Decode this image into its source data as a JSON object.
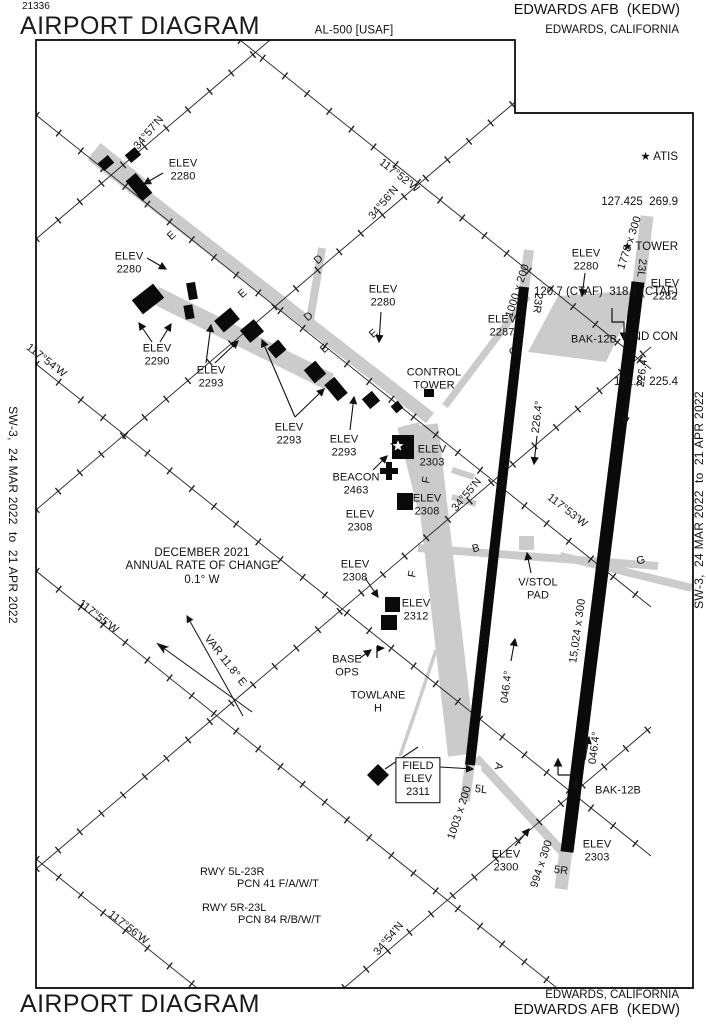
{
  "header": {
    "chart_number": "21336",
    "title": "AIRPORT DIAGRAM",
    "procedure_id": "AL-500 [USAF]",
    "airport": "EDWARDS AFB  (KEDW)",
    "city": "EDWARDS, CALIFORNIA"
  },
  "frequencies": {
    "atis_label": "★ ATIS",
    "atis_freqs": "127.425  269.9",
    "tower_label": "★ TOWER",
    "tower_freqs": "120.7 (CTAF)  318.1 (CTAF)",
    "gnd_label": "GND CON",
    "gnd_freqs": "121.8  225.4"
  },
  "edges": {
    "left": "SW-3,  24 MAR 2022  to  21 APR 2022",
    "right": "SW-3,  24 MAR 2022  to  21 APR 2022"
  },
  "footer": {
    "title": "AIRPORT DIAGRAM",
    "city": "EDWARDS, CALIFORNIA",
    "airport": "EDWARDS AFB  (KEDW)"
  },
  "colors": {
    "runway": "#0a0a0a",
    "taxiway": "#cbcbcb",
    "ink": "#111111"
  },
  "map": {
    "labels": {
      "lat57": "34°57'N",
      "lat56": "34°56'N",
      "lat55": "34°55'N",
      "lat54": "34°54'N",
      "lon52": "117°52'W",
      "lon53": "117°53'W",
      "lon54": "117°54'W",
      "lon55": "117°55'W",
      "lon56": "117°56'W",
      "elev2280a": "ELEV\n2280",
      "elev2280b": "ELEV\n2280",
      "elev2280c": "ELEV\n2280",
      "elev2280d": "ELEV\n2280",
      "elev2290": "ELEV\n2290",
      "elev2293a": "ELEV\n2293",
      "elev2293b": "ELEV\n2293",
      "elev2293c": "ELEV\n2293",
      "elev2287": "ELEV\n2287",
      "elev2282": "ELEV\n2282",
      "control_tower": "CONTROL\nTOWER",
      "elev2303a": "ELEV\n2303",
      "beacon": "BEACON\n2463",
      "elev2308a": "ELEV\n2308",
      "elev2308b": "ELEV\n2308",
      "elev2308c": "ELEV\n2308",
      "elev2312": "ELEV\n2312",
      "base_ops": "BASE\nOPS",
      "towlane": "TOWLANE\nH",
      "field_elev": "FIELD\nELEV\n2311",
      "elev2300": "ELEV\n2300",
      "elev2303b": "ELEV\n2303",
      "bak12b_top": "BAK-12B",
      "bak12b_bottom": "BAK-12B",
      "vstol": "V/STOL\nPAD",
      "mag_note": "DECEMBER 2021\nANNUAL RATE OF CHANGE\n0.1° W",
      "var_label": "VAR 11.8° E",
      "rwy1": "RWY 5L-23R",
      "pcn1": "PCN 41 F/A/W/T",
      "rwy2": "RWY 5R-23L",
      "pcn2": "PCN 84 R/B/W/T",
      "dim_1000": "1000 x 200",
      "dim_1778": "1778 x 300",
      "dim_12000": "12,000 x 200",
      "dim_15024": "15,024 x 300",
      "dim_1003": "1003 x 200",
      "dim_994": "994 x 300",
      "thr_23r": "23R",
      "thr_23l": "23L",
      "thr_5l": "5L",
      "thr_5r": "5R",
      "hdg_226a": "226.4°",
      "hdg_226b": "226.4°",
      "hdg_046a": "046.4°",
      "hdg_046b": "046.4°",
      "twy_e1": "E",
      "twy_e2": "E",
      "twy_e3": "E",
      "twy_e4": "E",
      "twy_d1": "D",
      "twy_d2": "D",
      "twy_c": "C",
      "twy_b": "B",
      "twy_f1": "F",
      "twy_f2": "F",
      "twy_g": "G",
      "twy_a": "A"
    }
  }
}
